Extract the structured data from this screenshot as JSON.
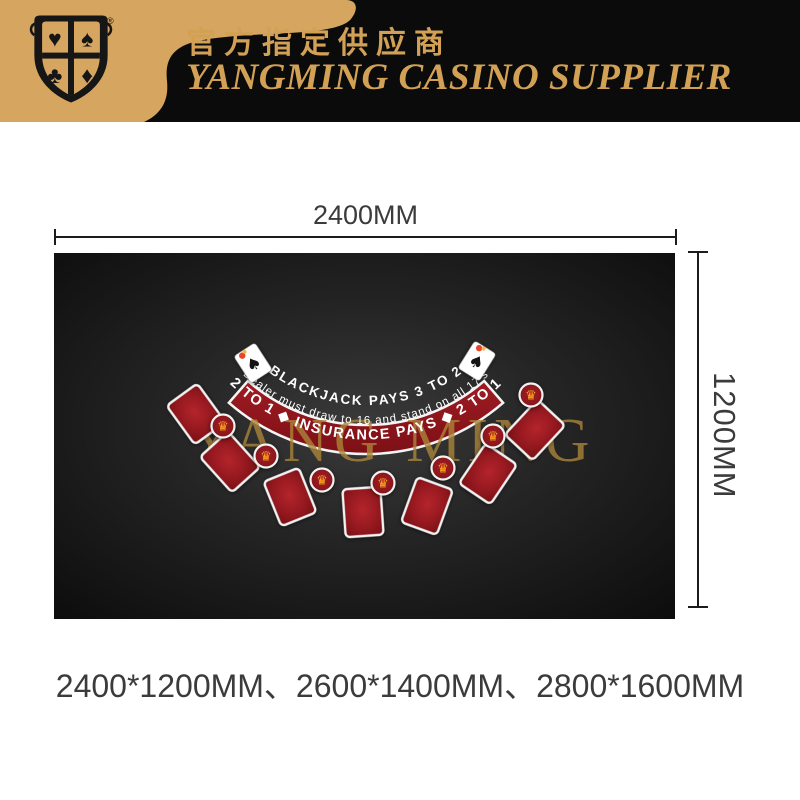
{
  "header": {
    "chinese_tagline": "官方指定供应商",
    "brand": "YANGMING CASINO SUPPLIER",
    "registered_mark": "®",
    "logo_suits": [
      "♥",
      "♠",
      "♣",
      "♦"
    ]
  },
  "dimensions": {
    "width_label": "2400MM",
    "height_label": "1200MM",
    "available_sizes": "2400*1200MM、2600*1400MM、2800*1600MM"
  },
  "felt": {
    "blackjack_line": "BLACKJACK PAYS 3 TO 2",
    "dealer_line": "Dealer must draw to 16 and stand on all 17's",
    "insurance_line": "2 TO 1 ◆ INSURANCE PAYS ◆ 2 TO 1",
    "watermark": "YANG MING",
    "card_spots": [
      {
        "x": 142,
        "y": 161,
        "rot": -36
      },
      {
        "x": 176,
        "y": 209,
        "rot": -42
      },
      {
        "x": 236,
        "y": 244,
        "rot": -22
      },
      {
        "x": 309,
        "y": 259,
        "rot": -4
      },
      {
        "x": 373,
        "y": 253,
        "rot": 20
      },
      {
        "x": 434,
        "y": 221,
        "rot": 34
      },
      {
        "x": 481,
        "y": 177,
        "rot": 43
      }
    ],
    "bet_circles": [
      {
        "x": 169,
        "y": 173
      },
      {
        "x": 212,
        "y": 203
      },
      {
        "x": 268,
        "y": 227
      },
      {
        "x": 329,
        "y": 230
      },
      {
        "x": 389,
        "y": 215
      },
      {
        "x": 439,
        "y": 183
      },
      {
        "x": 477,
        "y": 142
      }
    ],
    "ace_cards": [
      {
        "x": 199,
        "y": 110,
        "rot": -33
      },
      {
        "x": 423,
        "y": 108,
        "rot": 32
      }
    ]
  },
  "icons": {
    "crown": "♛",
    "spade": "♠"
  },
  "colors": {
    "gold": "#d2a155",
    "gold_panel": "#d6a55f",
    "header_black": "#0b0b0b",
    "felt_dark": "#141414",
    "spot_red": "#a11d24",
    "band_red": "#8c151b",
    "dim_text": "#3b3b3b"
  }
}
